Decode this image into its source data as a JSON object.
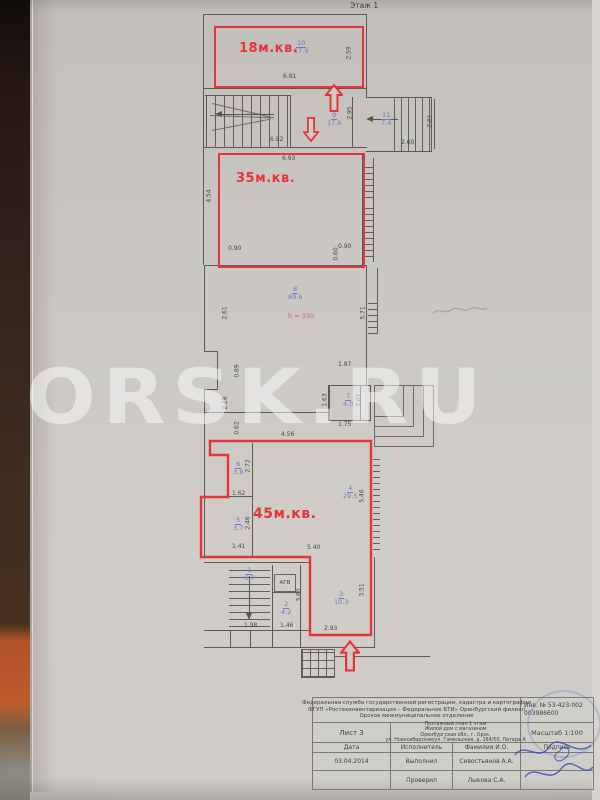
{
  "plan": {
    "floor_label": "Этаж 1",
    "height_note": "h = 330",
    "agv_label": "АГВ"
  },
  "watermark": {
    "text": "ORSK.RU"
  },
  "apartments": [
    {
      "label": "18м.кв."
    },
    {
      "label": "35м.кв."
    },
    {
      "label": "45м.кв."
    }
  ],
  "rooms": [
    {
      "num": "10",
      "area": "17.9"
    },
    {
      "num": "9",
      "area": "17.6"
    },
    {
      "num": "11",
      "area": "7.4"
    },
    {
      "num": "8",
      "area": "89.6"
    },
    {
      "num": "7",
      "area": "4.0"
    },
    {
      "num": "6",
      "area": "3.8"
    },
    {
      "num": "5",
      "area": "3.7"
    },
    {
      "num": "4",
      "area": "29.5"
    },
    {
      "num": "1",
      "area": "6.7"
    },
    {
      "num": "2",
      "area": "4.2"
    },
    {
      "num": "3",
      "area": "10.3"
    }
  ],
  "dims": [
    {
      "t": "6.91"
    },
    {
      "t": "2.59"
    },
    {
      "t": "6.92"
    },
    {
      "t": "2.95"
    },
    {
      "t": "2.60"
    },
    {
      "t": "2.81"
    },
    {
      "t": "6.93"
    },
    {
      "t": "4.54"
    },
    {
      "t": "0.90"
    },
    {
      "t": "0.90"
    },
    {
      "t": "0.60"
    },
    {
      "t": "2.61"
    },
    {
      "t": "5.71"
    },
    {
      "t": "1.87"
    },
    {
      "t": "0.89"
    },
    {
      "t": "2.28"
    },
    {
      "t": "0.62"
    },
    {
      "t": "4.56"
    },
    {
      "t": "1.63"
    },
    {
      "t": "2.01"
    },
    {
      "t": "1.75"
    },
    {
      "t": "2.72"
    },
    {
      "t": "1.62"
    },
    {
      "t": "2.46"
    },
    {
      "t": "1.41"
    },
    {
      "t": "5.46"
    },
    {
      "t": "5.40"
    },
    {
      "t": "1.98"
    },
    {
      "t": "1.46"
    },
    {
      "t": "3.60"
    },
    {
      "t": "3.51"
    },
    {
      "t": "2.93"
    }
  ],
  "titleblock": {
    "org_lines": [
      "Федеральная служба государственной регистрации, кадастра и картографии",
      "ФГУП «Ростехинвентаризация – Федеральное БТИ» Оренбургский филиал",
      "Орское межмуниципальное отделение"
    ],
    "inv_line1": "Инв. № 53-423-002",
    "inv_line2": "003986600",
    "sheet": "Лист 3",
    "doc_lines": [
      "Поэтажный план 1 этаж",
      "Жилой дом с магазином",
      "Оренбургская обл., г. Орск,",
      "ул. Новосибирская/ул. Гомельская, д. 164/50, Литера А"
    ],
    "scale": "Масштаб 1:100",
    "cols": {
      "date": "Дата",
      "exec": "Исполнитель",
      "name": "Фамилия И.О.",
      "sign": "Подпись"
    },
    "rows": [
      {
        "date": "03.04.2014",
        "role": "Выполнил",
        "name": "Севостьянов А.А."
      },
      {
        "date": "",
        "role": "Проверил",
        "name": "Лыкова С.А."
      }
    ]
  },
  "colors": {
    "red": "#e8333a",
    "blue": "#7177c2",
    "ink": "#5a5a5a",
    "hnote": "#b96a6a",
    "sig": "#3247b8"
  }
}
